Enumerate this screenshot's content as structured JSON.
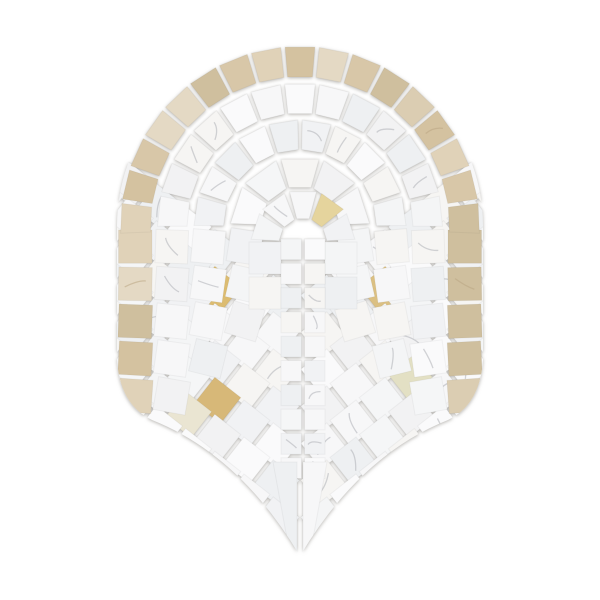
{
  "meta": {
    "description": "Product photo of an arched fan / shield shaped natural stone mosaic tile on a plain white background: outer border of beige travertine squares around a round-top arch and down the sides, interior of white carrara-style marble squares arranged as concentric rings over a small central arch, transitioning to chevron rows that taper to a pointed tip, with a few honey-gold onyx accent squares"
  },
  "palette": {
    "background": "#ffffff",
    "grout": "#ffffff",
    "marble_whites": [
      "#f4f5f6",
      "#f1f2f4",
      "#f7f7f8",
      "#eef0f2",
      "#f6f5f3",
      "#fafafb",
      "#f2f2f3",
      "#f5f6f7"
    ],
    "border_beiges": [
      "#d8c7a8",
      "#e0d2b8",
      "#cfbf9e",
      "#e4d9c4",
      "#d4c2a0",
      "#dbcdb2"
    ],
    "vein": "#aeb0b6",
    "speckle": "#b9a684",
    "shadow": "rgba(112,108,100,0.5)"
  },
  "geometry": {
    "canvas": {
      "width": 600,
      "height": 600
    },
    "center": {
      "x": 300,
      "y": 226
    },
    "outline": "M 117,226 A 183 183 0 0 1 483,226 L 483,360 Q 480,405 448,420 Q 360,455 300,556 Q 240,455 152,420 Q 120,405 117,360 Z",
    "rings": [
      {
        "kind": "beige",
        "r_in": 147.5,
        "r_out": 181.5,
        "count": 17,
        "a_start": 183,
        "a_end": -3
      },
      {
        "kind": "white",
        "r_in": 111.0,
        "r_out": 144.5,
        "count": 13,
        "a_start": 181,
        "a_end": -1
      },
      {
        "kind": "white",
        "r_in": 74.5,
        "r_out": 108.0,
        "count": 10,
        "a_start": 181,
        "a_end": -1
      },
      {
        "kind": "white",
        "r_in": 38.0,
        "r_out": 71.5,
        "count": 5,
        "a_start": 180,
        "a_end": 0
      }
    ],
    "side_columns": [
      {
        "kind": "beige",
        "x": 118.5,
        "w": 33.5,
        "rows": 5,
        "y0": 230,
        "pitch": 37.3,
        "tilt0": 0,
        "tilt_step": 1
      },
      {
        "kind": "white",
        "x": 155.5,
        "w": 32.5,
        "rows": 5,
        "y0": 230,
        "pitch": 37.3,
        "tilt0": 2,
        "tilt_step": 2
      },
      {
        "kind": "white",
        "x": 192.0,
        "w": 32.5,
        "rows": 4,
        "y0": 230,
        "pitch": 37.3,
        "tilt0": 5,
        "tilt_step": 3
      },
      {
        "kind": "white",
        "x": 228.5,
        "w": 32.5,
        "rows": 3,
        "y0": 230,
        "pitch": 37.3,
        "tilt0": 9,
        "tilt_step": 4
      }
    ],
    "inner_arch": {
      "cx": 303,
      "cy": 242,
      "r_in": 22,
      "r_out": 54,
      "count": 5,
      "leg_rows": 2,
      "leg_size": 32,
      "leg_pitch": 35
    },
    "central_grid": {
      "xs": [
        281,
        304.5
      ],
      "w": 20.5,
      "y0": 239,
      "pitch": 24.3,
      "rows": 10
    },
    "chevrons": {
      "vertex_ys": [
        318,
        355,
        392,
        429,
        466,
        503,
        540
      ],
      "seam_left_x": 276,
      "seam_right_x": 324,
      "start_y_offset": 20,
      "step_x": 29.2,
      "step_y": 22.8,
      "size": 33,
      "rot": 38,
      "tiles_per_wing": 8
    },
    "tip_tiles": {
      "left": [
        [
          273,
          462
        ],
        [
          297,
          462
        ],
        [
          297,
          552
        ],
        [
          290,
          555
        ]
      ],
      "right": [
        [
          303,
          462
        ],
        [
          327,
          462
        ],
        [
          310,
          555
        ],
        [
          303,
          552
        ]
      ]
    }
  },
  "accent_tiles": [
    {
      "x": 331,
      "y": 207,
      "color": "#e5d49d"
    },
    {
      "x": 206,
      "y": 302,
      "color": "#dcbc71"
    },
    {
      "x": 398,
      "y": 292,
      "color": "#dbc083"
    },
    {
      "x": 219,
      "y": 399,
      "color": "#d7b878"
    },
    {
      "x": 411,
      "y": 379,
      "color": "#e3e0c4"
    },
    {
      "x": 190,
      "y": 416,
      "color": "#eae5d2"
    }
  ]
}
